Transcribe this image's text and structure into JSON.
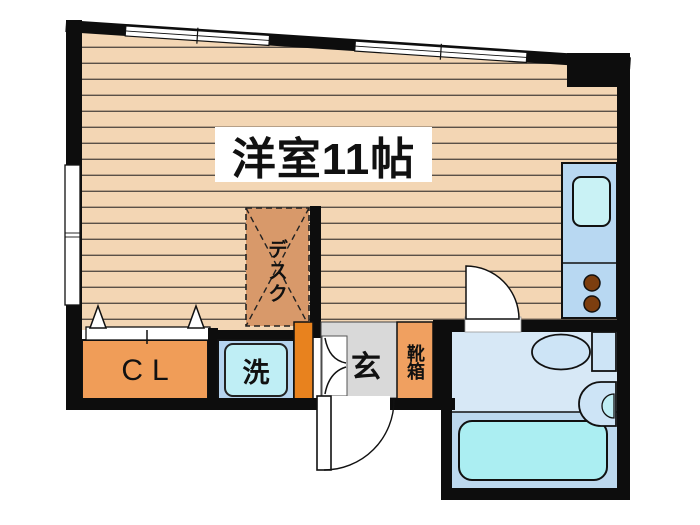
{
  "plan": {
    "room_label": "洋室11帖",
    "desk_label": "デスク",
    "closet_label": "CL",
    "laundry_label": "洗",
    "entrance_label": "玄",
    "shoebox_label": "靴箱"
  },
  "colors": {
    "wall": "#0d0d0d",
    "floor": "#f3d6b4",
    "floor_line": "#5a5148",
    "desk_orange": "#d8996a",
    "closet_orange": "#f09d58",
    "shoebox_orange": "#f0a060",
    "deep_orange": "#e8821e",
    "laundry_pan_blue": "#b6d4ef",
    "washer_cyan": "#bfeef5",
    "kitchen_blue": "#b8d8f2",
    "kitchen_sink_cyan": "#c9f2f5",
    "burner_brown": "#7c3e0f",
    "bath_upper_blue": "#d7e8f6",
    "bath_lower_blue": "#bcd8ee",
    "tub_cyan": "#abeef2",
    "toilet_blue": "#cde4f6",
    "entrance_gray": "#d9d9d9",
    "door_white": "#ffffff"
  }
}
